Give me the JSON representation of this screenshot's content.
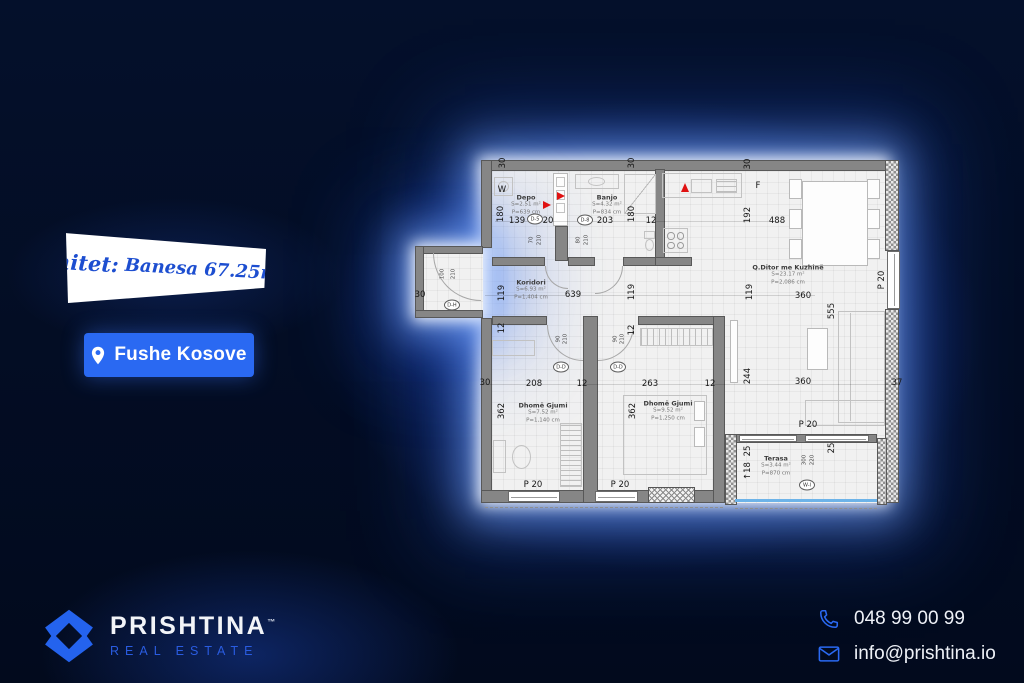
{
  "banner": {
    "script": "Shitet:",
    "rest": "Banesa 67.25m2"
  },
  "location": {
    "label": "Fushe Kosove"
  },
  "brand": {
    "name": "PRISHTINA",
    "tm": "™",
    "tagline": "REAL ESTATE"
  },
  "contact": {
    "phone": "048 99 00 99",
    "email": "info@prishtina.io"
  },
  "colors": {
    "accent_blue": "#2a69f2",
    "banner_text": "#1d4ed0",
    "background": "#030c20",
    "wall_gray": "#868686",
    "red_arrow": "#e01212",
    "rail_blue": "#6db3e8"
  },
  "floorplan": {
    "rooms": [
      {
        "name": "Depo",
        "s": "S=2.51 m²",
        "p": "P=639 cm",
        "x": 121,
        "y": 62
      },
      {
        "name": "Banjo",
        "s": "S=4.32 m²",
        "p": "P=834 cm",
        "x": 202,
        "y": 62
      },
      {
        "name": "Koridori",
        "s": "S=6.93 m²",
        "p": "P=1,404 cm",
        "x": 126,
        "y": 147
      },
      {
        "name": "Q.Ditor me Kuzhinë",
        "s": "S=23.17 m²",
        "p": "P=2,086 cm",
        "x": 383,
        "y": 132
      },
      {
        "name": "Dhomë Gjumi",
        "s": "S=7.52 m²",
        "p": "P=1,140 cm",
        "x": 138,
        "y": 270
      },
      {
        "name": "Dhomë Gjumi",
        "s": "S=9.52 m²",
        "p": "P=1,250 cm",
        "x": 263,
        "y": 268
      },
      {
        "name": "Terasa",
        "s": "S=3.44 m²",
        "p": "P=870 cm",
        "x": 371,
        "y": 323
      }
    ],
    "dims": [
      {
        "t": "30",
        "x": 98,
        "y": 20,
        "r": 90
      },
      {
        "t": "30",
        "x": 227,
        "y": 20,
        "r": 90
      },
      {
        "t": "30",
        "x": 343,
        "y": 21,
        "r": 90
      },
      {
        "t": "180",
        "x": 96,
        "y": 71,
        "r": 90
      },
      {
        "t": "139",
        "x": 112,
        "y": 78
      },
      {
        "t": "20",
        "x": 143,
        "y": 78
      },
      {
        "t": "203",
        "x": 200,
        "y": 78
      },
      {
        "t": "180",
        "x": 227,
        "y": 71,
        "r": 90
      },
      {
        "t": "12",
        "x": 246,
        "y": 78
      },
      {
        "t": "W",
        "x": 97,
        "y": 47
      },
      {
        "t": "F",
        "x": 353,
        "y": 43
      },
      {
        "t": "192",
        "x": 343,
        "y": 72,
        "r": 90
      },
      {
        "t": "488",
        "x": 372,
        "y": 78
      },
      {
        "t": "30",
        "x": 15,
        "y": 152
      },
      {
        "t": "119",
        "x": 97,
        "y": 150,
        "r": 90
      },
      {
        "t": "639",
        "x": 168,
        "y": 152
      },
      {
        "t": "119",
        "x": 227,
        "y": 149,
        "r": 90
      },
      {
        "t": "119",
        "x": 345,
        "y": 149,
        "r": 90
      },
      {
        "t": "360",
        "x": 398,
        "y": 153
      },
      {
        "t": "555",
        "x": 427,
        "y": 168,
        "r": 90
      },
      {
        "t": "100",
        "x": 38,
        "y": 131,
        "r": 90,
        "sm": true
      },
      {
        "t": "210",
        "x": 49,
        "y": 131,
        "r": 90,
        "sm": true
      },
      {
        "t": "70",
        "x": 127,
        "y": 97,
        "r": 90,
        "sm": true
      },
      {
        "t": "210",
        "x": 135,
        "y": 97,
        "r": 90,
        "sm": true
      },
      {
        "t": "80",
        "x": 174,
        "y": 97,
        "r": 90,
        "sm": true
      },
      {
        "t": "210",
        "x": 182,
        "y": 97,
        "r": 90,
        "sm": true
      },
      {
        "t": "12",
        "x": 97,
        "y": 185,
        "r": 90
      },
      {
        "t": "12",
        "x": 227,
        "y": 187,
        "r": 90
      },
      {
        "t": "90",
        "x": 154,
        "y": 196,
        "r": 90,
        "sm": true
      },
      {
        "t": "210",
        "x": 161,
        "y": 196,
        "r": 90,
        "sm": true
      },
      {
        "t": "90",
        "x": 211,
        "y": 196,
        "r": 90,
        "sm": true
      },
      {
        "t": "210",
        "x": 218,
        "y": 196,
        "r": 90,
        "sm": true
      },
      {
        "t": "30",
        "x": 80,
        "y": 240
      },
      {
        "t": "208",
        "x": 129,
        "y": 241
      },
      {
        "t": "12",
        "x": 177,
        "y": 241
      },
      {
        "t": "263",
        "x": 245,
        "y": 241
      },
      {
        "t": "12",
        "x": 305,
        "y": 241
      },
      {
        "t": "244",
        "x": 343,
        "y": 233,
        "r": 90
      },
      {
        "t": "360",
        "x": 398,
        "y": 239
      },
      {
        "t": "37",
        "x": 492,
        "y": 240
      },
      {
        "t": "362",
        "x": 97,
        "y": 268,
        "r": 90
      },
      {
        "t": "362",
        "x": 228,
        "y": 268,
        "r": 90
      },
      {
        "t": "P 20",
        "x": 477,
        "y": 137,
        "r": 90
      },
      {
        "t": "P 20",
        "x": 128,
        "y": 342
      },
      {
        "t": "P 20",
        "x": 215,
        "y": 342
      },
      {
        "t": "P 20",
        "x": 403,
        "y": 282
      },
      {
        "t": "25",
        "x": 343,
        "y": 308,
        "r": 90
      },
      {
        "t": "25",
        "x": 427,
        "y": 305,
        "r": 90
      },
      {
        "t": "↑18",
        "x": 343,
        "y": 328,
        "r": 90
      },
      {
        "t": "300",
        "x": 400,
        "y": 317,
        "r": 90,
        "sm": true
      },
      {
        "t": "220",
        "x": 408,
        "y": 317,
        "r": 90,
        "sm": true
      }
    ],
    "markers": [
      {
        "t": "D-5",
        "x": 130,
        "y": 76
      },
      {
        "t": "D-8",
        "x": 180,
        "y": 77
      },
      {
        "t": "D-H",
        "x": 47,
        "y": 162
      },
      {
        "t": "D-D",
        "x": 156,
        "y": 224
      },
      {
        "t": "D-D",
        "x": 213,
        "y": 224
      },
      {
        "t": "W-I",
        "x": 402,
        "y": 342
      }
    ]
  }
}
